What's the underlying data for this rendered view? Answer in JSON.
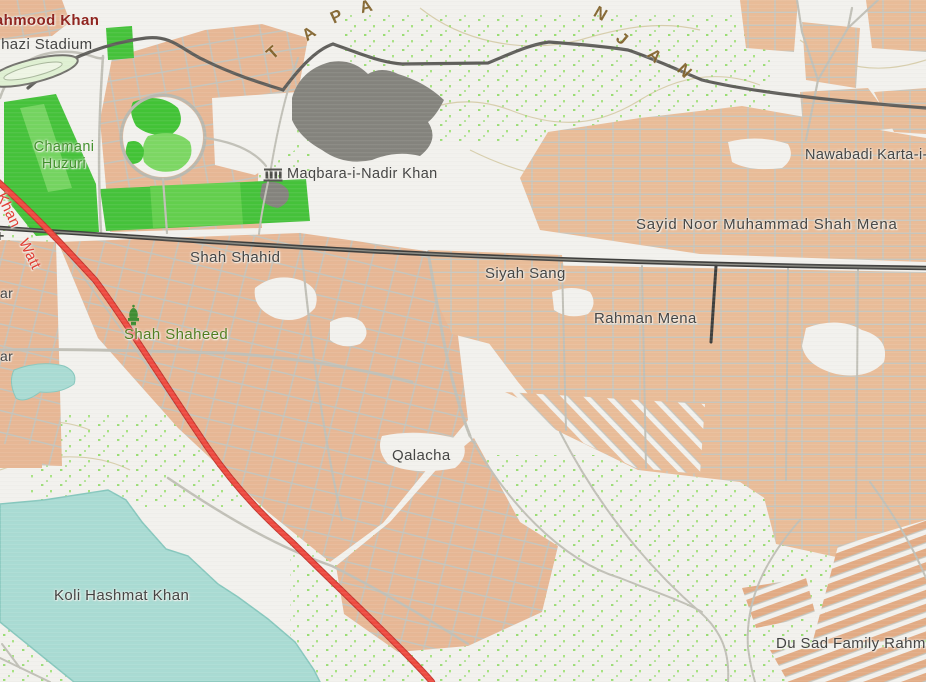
{
  "map": {
    "labels": {
      "mahmood_khan": "Mahmood Khan",
      "ghazi_stadium": "Ghazi Stadium",
      "chamani_line1": "Chamani",
      "chamani_line2": "Huzuri",
      "maqbara": "Maqbara-i-Nadir Khan",
      "nawabadi": "Nawabadi Karta-i-N",
      "sayid_noor": "Sayid Noor Muhammad Shah Mena",
      "shah_shahid": "Shah Shahid",
      "siyah_sang": "Siyah Sang",
      "rahman_mena": "Rahman Mena",
      "shah_shaheed": "Shah Shaheed",
      "khan_watt": "Khan Watt",
      "qalacha": "Qalacha",
      "koli_hashmat_khan": "Koli Hashmat Khan",
      "du_sad": "Du Sad Family Rahman",
      "partial_ar_1": "ar",
      "partial_ar_2": "ar",
      "partial_plus": "+"
    },
    "hill_letters": [
      "T",
      "A",
      "P",
      "A",
      "N",
      "J",
      "A",
      "N"
    ],
    "colors": {
      "background": "#f2f1ed",
      "urban_block": "#e8bb97",
      "street": "#c4c3ba",
      "major_road": "#3e3e3c",
      "red_road": "#ee4a40",
      "park_green": "#45c23a",
      "water_teal": "#a9dbd3",
      "hill_gray": "#84837d",
      "contour": "#d5cba6",
      "label_gray": "#414140",
      "label_green": "#3f8f29",
      "label_maroon": "#8e211c",
      "label_red": "#e0392f",
      "hill_text_brown": "#7c5d24"
    }
  }
}
